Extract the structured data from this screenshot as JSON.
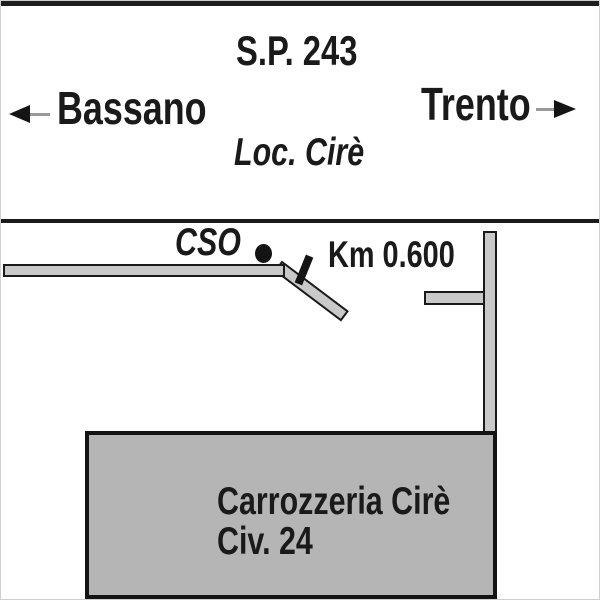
{
  "signpost": {
    "road_name": "S.P. 243",
    "left_destination": "Bassano",
    "right_destination": "Trento",
    "locality": "Loc. Cirè"
  },
  "map": {
    "poi_label": "CSO",
    "km_label": "Km 0.600",
    "building_line1": "Carrozzeria Cirè",
    "building_line2": "Civ. 24"
  },
  "colors": {
    "road_fill": "#c9c9c9",
    "building_fill": "#b5b5b5",
    "outline": "#1a1a1a",
    "arrow_tail_gray": "#999999"
  }
}
